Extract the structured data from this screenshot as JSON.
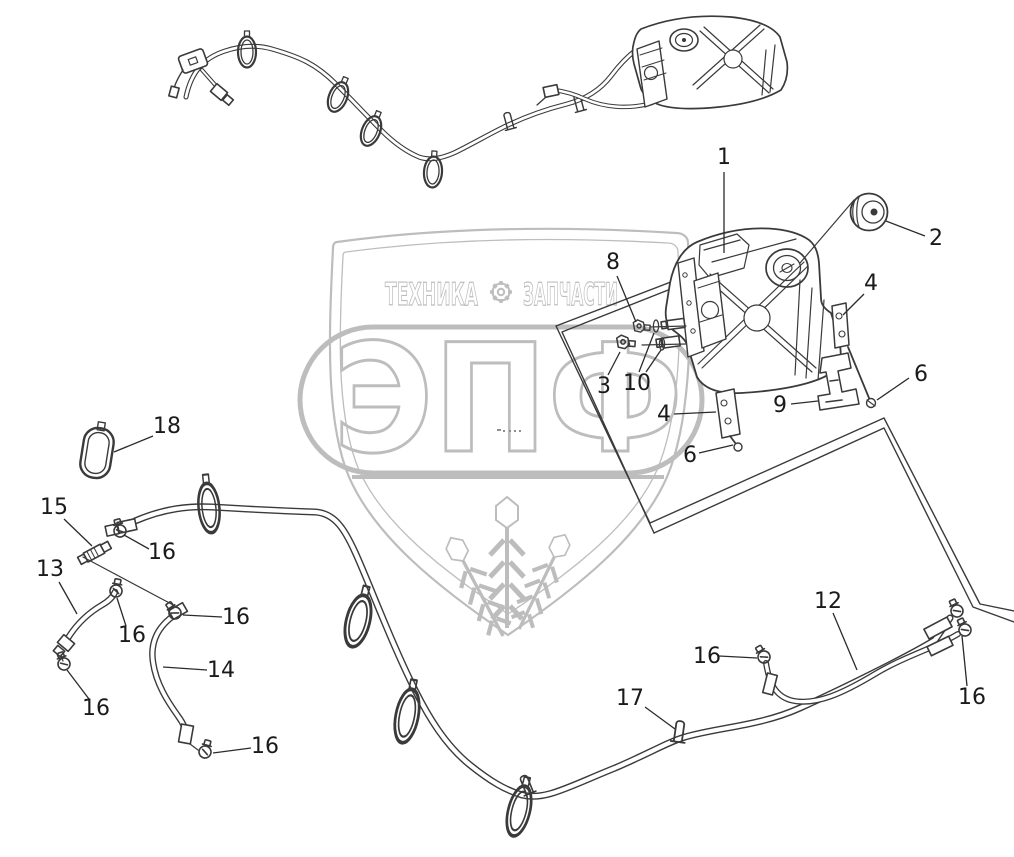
{
  "page": {
    "width": 1014,
    "height": 857,
    "background": "#ffffff",
    "line_color": "#2b2b2b",
    "label_color": "#1a1a1a",
    "watermark_color": "#bdbdbd"
  },
  "watermark": {
    "title_left": "ТЕХНИКА",
    "title_right": "ЗАПЧАСТИ",
    "gear_icon": "gear",
    "big_text": "ЭПФ",
    "dots": ".-  ..."
  },
  "diagram": {
    "type": "exploded-parts-diagram",
    "part_numbers": [
      "1",
      "2",
      "3",
      "4",
      "6",
      "8",
      "9",
      "10",
      "12",
      "13",
      "14",
      "15",
      "16",
      "17",
      "18"
    ]
  },
  "callouts": [
    {
      "id": "1",
      "text": "1",
      "x": 724,
      "y": 158,
      "leaders": [
        [
          724,
          172,
          724,
          253
        ]
      ]
    },
    {
      "id": "2",
      "text": "2",
      "x": 936,
      "y": 239,
      "leaders": [
        [
          925,
          236,
          886,
          221
        ]
      ]
    },
    {
      "id": "8",
      "text": "8",
      "x": 613,
      "y": 263,
      "leaders": [
        [
          617,
          276,
          636,
          322
        ]
      ]
    },
    {
      "id": "4a",
      "text": "4",
      "x": 871,
      "y": 284,
      "leaders": [
        [
          864,
          294,
          843,
          315
        ]
      ]
    },
    {
      "id": "6a",
      "text": "6",
      "x": 921,
      "y": 375,
      "leaders": [
        [
          909,
          378,
          877,
          400
        ]
      ]
    },
    {
      "id": "9",
      "text": "9",
      "x": 780,
      "y": 406,
      "leaders": [
        [
          791,
          404,
          818,
          401
        ]
      ]
    },
    {
      "id": "3",
      "text": "3",
      "x": 604,
      "y": 387,
      "leaders": [
        [
          608,
          375,
          620,
          352
        ]
      ]
    },
    {
      "id": "10",
      "text": "10",
      "x": 637,
      "y": 384,
      "leaders": [
        [
          639,
          372,
          654,
          333
        ],
        [
          646,
          372,
          661,
          350
        ]
      ]
    },
    {
      "id": "4b",
      "text": "4",
      "x": 664,
      "y": 415,
      "leaders": [
        [
          674,
          414,
          716,
          412
        ]
      ]
    },
    {
      "id": "6b",
      "text": "6",
      "x": 690,
      "y": 456,
      "leaders": [
        [
          699,
          453,
          733,
          445
        ]
      ]
    },
    {
      "id": "18",
      "text": "18",
      "x": 167,
      "y": 427,
      "leaders": [
        [
          153,
          436,
          114,
          452
        ]
      ]
    },
    {
      "id": "15",
      "text": "15",
      "x": 54,
      "y": 508,
      "leaders": [
        [
          64,
          519,
          92,
          546
        ]
      ]
    },
    {
      "id": "16a",
      "text": "16",
      "x": 162,
      "y": 553,
      "leaders": [
        [
          149,
          549,
          124,
          535
        ]
      ]
    },
    {
      "id": "13",
      "text": "13",
      "x": 50,
      "y": 570,
      "leaders": [
        [
          59,
          582,
          77,
          614
        ]
      ]
    },
    {
      "id": "16b",
      "text": "16",
      "x": 132,
      "y": 636,
      "leaders": [
        [
          126,
          626,
          117,
          598
        ]
      ]
    },
    {
      "id": "16c",
      "text": "16",
      "x": 236,
      "y": 618,
      "leaders": [
        [
          222,
          617,
          183,
          615
        ]
      ]
    },
    {
      "id": "14",
      "text": "14",
      "x": 221,
      "y": 671,
      "leaders": [
        [
          207,
          670,
          163,
          667
        ]
      ]
    },
    {
      "id": "16d",
      "text": "16",
      "x": 96,
      "y": 709,
      "leaders": [
        [
          89,
          699,
          67,
          670
        ]
      ]
    },
    {
      "id": "16e",
      "text": "16",
      "x": 265,
      "y": 747,
      "leaders": [
        [
          251,
          748,
          213,
          753
        ]
      ]
    },
    {
      "id": "16f",
      "text": "16",
      "x": 707,
      "y": 657,
      "leaders": [
        [
          719,
          656,
          757,
          658
        ]
      ]
    },
    {
      "id": "12",
      "text": "12",
      "x": 828,
      "y": 602,
      "leaders": [
        [
          833,
          613,
          857,
          670
        ]
      ]
    },
    {
      "id": "17",
      "text": "17",
      "x": 630,
      "y": 699,
      "leaders": [
        [
          645,
          707,
          675,
          729
        ]
      ]
    },
    {
      "id": "16g",
      "text": "16",
      "x": 972,
      "y": 698,
      "leaders": [
        [
          967,
          686,
          962,
          636
        ]
      ]
    }
  ]
}
